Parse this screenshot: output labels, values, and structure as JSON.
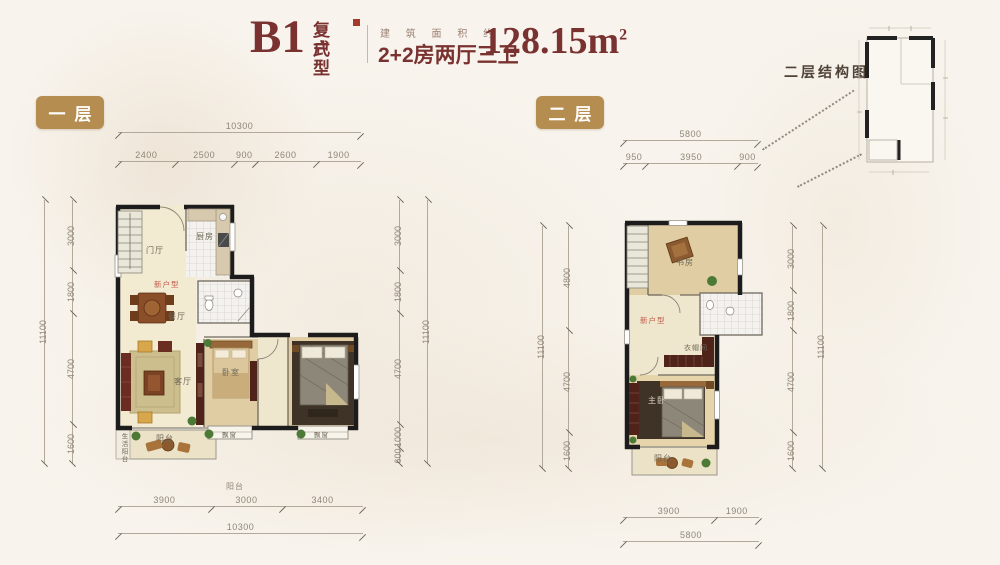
{
  "header": {
    "unit_code": "B1",
    "unit_type_line1": "复式",
    "unit_type_line2": "户型",
    "area_prefix": "建 筑 面 积 约",
    "layout_desc": "2+2房两厅三卫",
    "area_value": "128.15",
    "area_unit": "m",
    "area_sup": "2"
  },
  "badges": {
    "floor1": "一层",
    "floor2": "二层"
  },
  "structure_diagram": {
    "label": "二层结构图"
  },
  "floor1": {
    "rooms": {
      "entry": "门厅",
      "watermark": "新户型",
      "kitchen": "厨房",
      "dining": "餐厅",
      "living": "客厅",
      "bedroom": "卧室",
      "balcony": "阳台",
      "bay_left": "飘窗",
      "bay_right": "飘窗",
      "side_balcony": "生活阳台",
      "balcony_callout": "阳台"
    },
    "dims": {
      "top_total": "10300",
      "top_segments": [
        "2400",
        "2500",
        "900",
        "2600",
        "1900"
      ],
      "left_total": "11100",
      "left_segments": [
        "3000",
        "1800",
        "4700",
        "1600"
      ],
      "right_total": "11100",
      "right_segments": [
        "3000",
        "1800",
        "4700",
        "1000",
        "600"
      ],
      "bottom_total": "10300",
      "bottom_segments": [
        "3900",
        "3000",
        "3400"
      ]
    }
  },
  "floor2": {
    "rooms": {
      "study": "书房",
      "watermark": "新户型",
      "closet": "衣帽间",
      "master": "主卧",
      "balcony": "阳台"
    },
    "dims": {
      "top_total": "5800",
      "top_segments": [
        "950",
        "3950",
        "900"
      ],
      "left_total": "11100",
      "left_segments": [
        "4800",
        "4700",
        "1600"
      ],
      "right_total": "11100",
      "right_segments": [
        "3000",
        "1800",
        "4700",
        "1600"
      ],
      "bottom_total": "5800",
      "bottom_segments": [
        "3900",
        "1900"
      ]
    }
  },
  "colors": {
    "accent_maroon": "#7a3231",
    "badge_gold": "#b68d50",
    "watermark_red": "#c05a4a",
    "wall_black": "#1c1c1c"
  }
}
